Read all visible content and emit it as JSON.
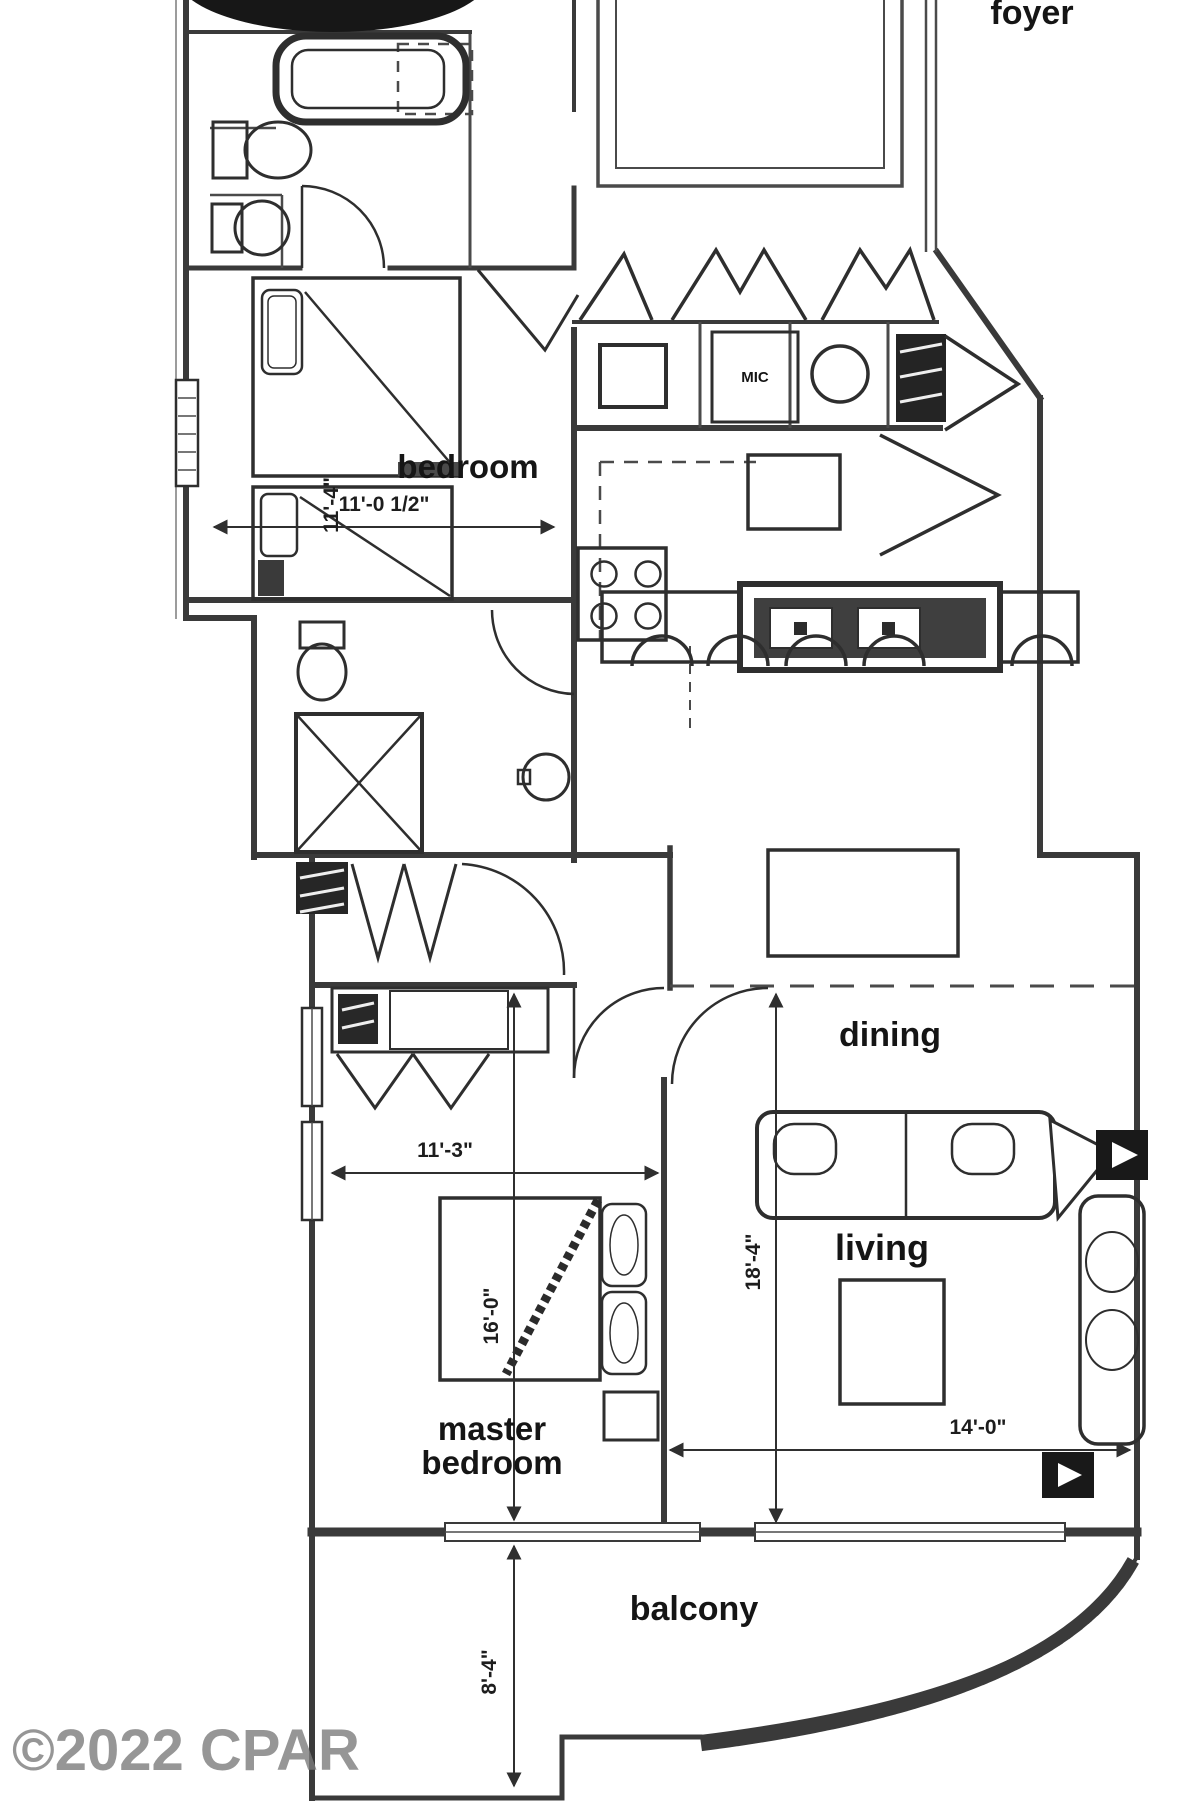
{
  "watermark": {
    "text": "©2022 CPAR"
  },
  "floor_plan": {
    "rooms": {
      "foyer": {
        "label": "foyer"
      },
      "bedroom": {
        "label": "bedroom",
        "width_dim": "11'-0 1/2\"",
        "height_dim": "11'-4\""
      },
      "dining": {
        "label": "dining"
      },
      "living": {
        "label": "living",
        "width_dim": "14'-0\"",
        "height_dim": "18'-4\""
      },
      "master_bedroom": {
        "label_line1": "master",
        "label_line2": "bedroom",
        "width_dim": "11'-3\"",
        "height_dim": "16'-0\""
      },
      "balcony": {
        "label": "balcony",
        "depth_dim": "8'-4\""
      }
    },
    "fixtures": {
      "mic_label": "MIC"
    },
    "colors": {
      "line": "#3a3a3a",
      "dark_fill": "#1c1c1c",
      "watermark": "#7c7c7c",
      "background": "#ffffff"
    }
  }
}
